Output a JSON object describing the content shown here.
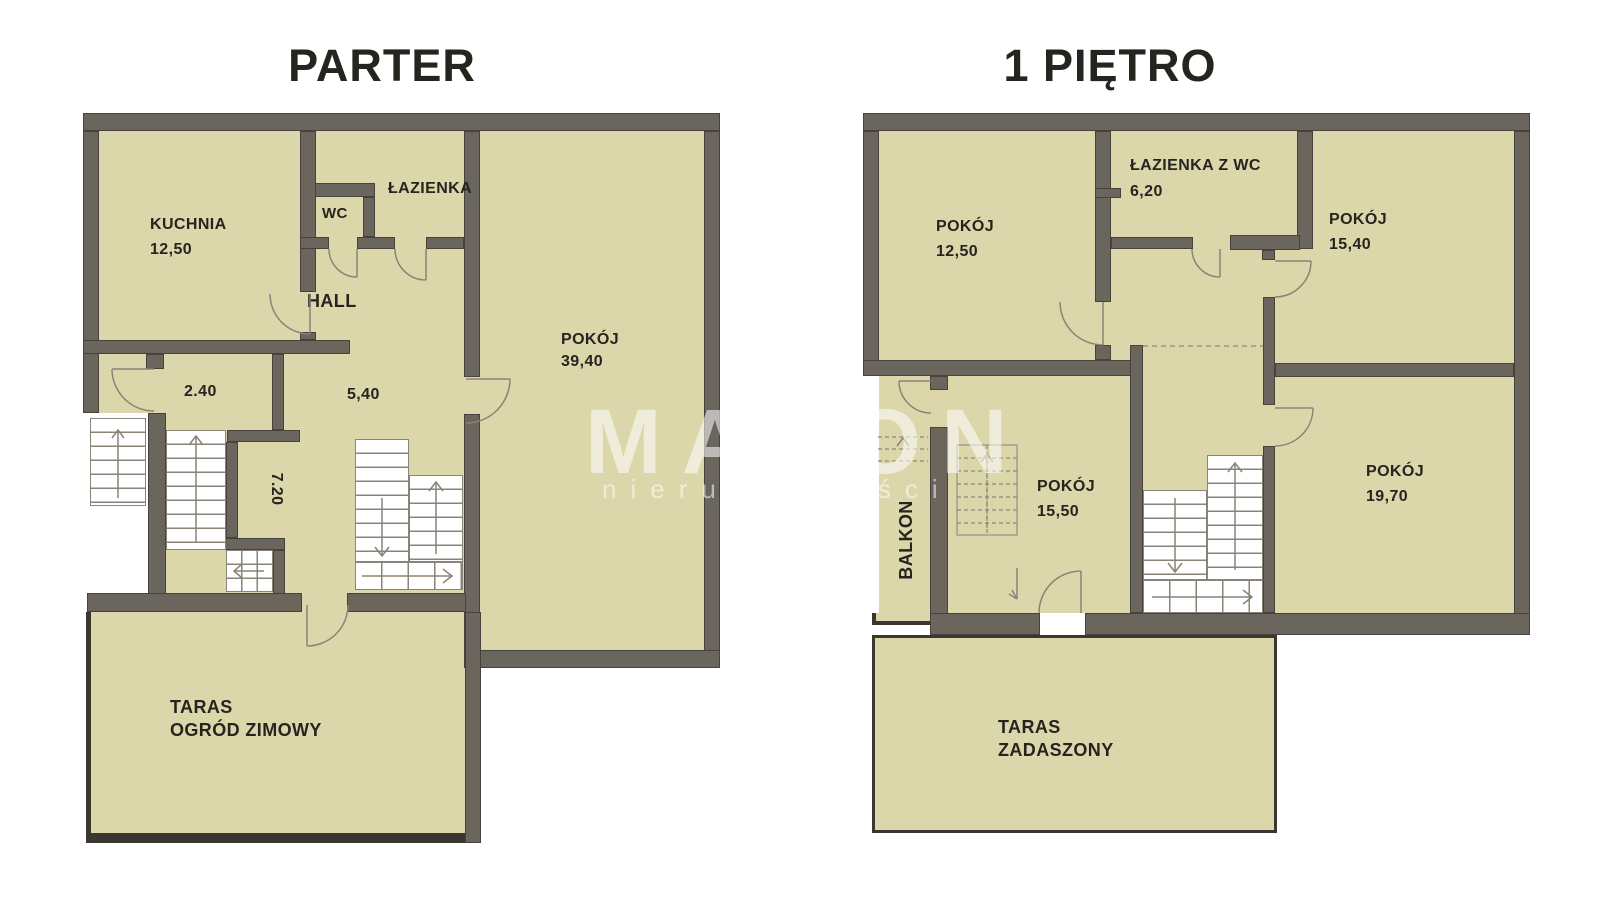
{
  "page": {
    "title_parter": "PARTER",
    "title_pietro": "1 PIĘTRO"
  },
  "watermark": {
    "brand": "MAXON",
    "subtitle": "nieruchomości"
  },
  "colors": {
    "background": "#FFFFFF",
    "wall": "#6B665D",
    "wall_outline": "#47433C",
    "floor": "#DCD6AB",
    "line": "#8A8478",
    "terrace_border": "#3A3731",
    "text": "#26241F",
    "watermark": "rgba(255,255,255,0.55)"
  },
  "parter": {
    "rooms": {
      "kuchnia": {
        "name": "KUCHNIA",
        "area": "12,50"
      },
      "wc": {
        "name": "WC"
      },
      "lazienka": {
        "name": "ŁAZIENKA"
      },
      "hall": {
        "name": "HALL",
        "area": "5,40"
      },
      "lobby": {
        "area": "2.40"
      },
      "corridor": {
        "area": "7.20"
      },
      "pokoj": {
        "name": "POKÓJ",
        "area": "39,40"
      },
      "taras": {
        "name": "TARAS",
        "name2": "OGRÓD ZIMOWY"
      }
    }
  },
  "pietro": {
    "rooms": {
      "pokoj1": {
        "name": "POKÓJ",
        "area": "12,50"
      },
      "lazienka": {
        "name": "ŁAZIENKA Z WC",
        "area": "6,20"
      },
      "pokoj2": {
        "name": "POKÓJ",
        "area": "15,40"
      },
      "pokoj3": {
        "name": "POKÓJ",
        "area": "15,50"
      },
      "pokoj4": {
        "name": "POKÓJ",
        "area": "19,70"
      },
      "balkon": {
        "name": "BALKON"
      },
      "taras": {
        "name": "TARAS",
        "name2": "ZADASZONY"
      }
    }
  }
}
